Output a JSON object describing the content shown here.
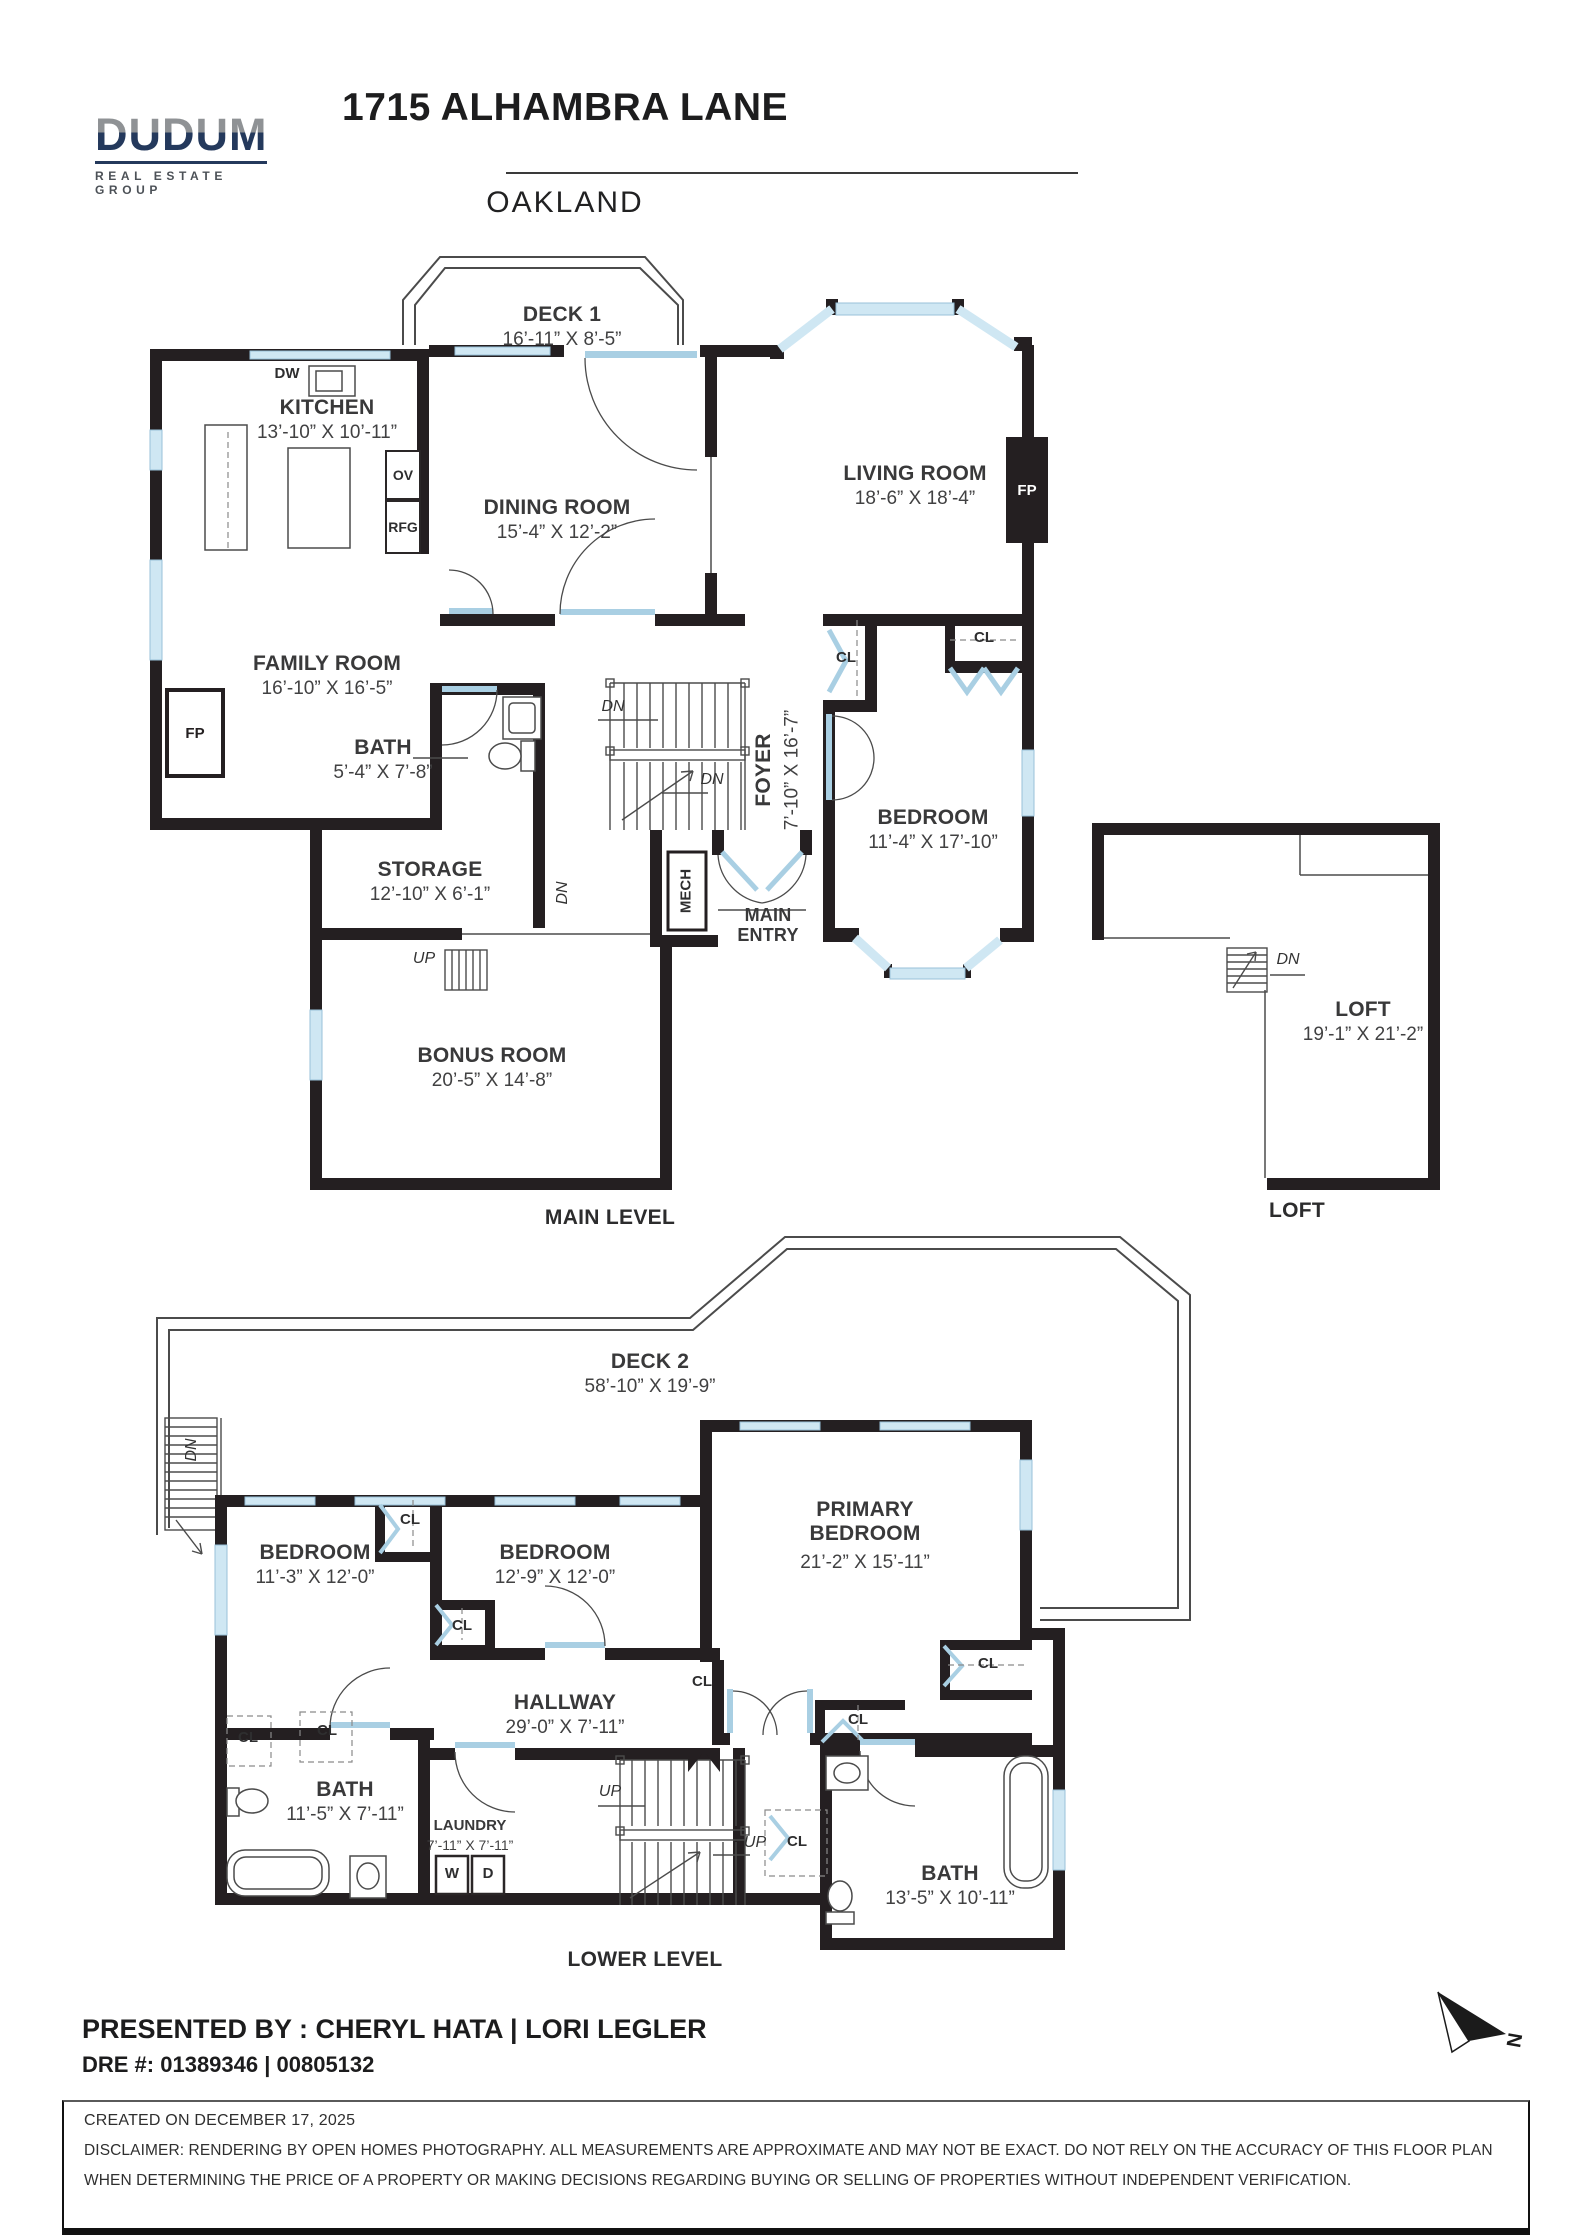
{
  "header": {
    "brand": "DUDUM",
    "brand_tagline": "REAL ESTATE GROUP",
    "title": "1715 ALHAMBRA LANE",
    "subtitle": "OAKLAND"
  },
  "main": {
    "caption": "MAIN LEVEL",
    "deck1": {
      "name": "DECK 1",
      "dims": "16’-11” X 8’-5”"
    },
    "kitchen": {
      "name": "KITCHEN",
      "dims": "13’-10” X 10’-11”"
    },
    "dining": {
      "name": "DINING ROOM",
      "dims": "15’-4” X 12’-2”"
    },
    "living": {
      "name": "LIVING ROOM",
      "dims": "18’-6” X 18’-4”"
    },
    "family": {
      "name": "FAMILY ROOM",
      "dims": "16’-10” X 16’-5”"
    },
    "bath": {
      "name": "BATH",
      "dims": "5’-4” X 7’-8”"
    },
    "foyer": {
      "name": "FOYER",
      "dims": "7’-10” X 16’-7”"
    },
    "bedroom": {
      "name": "BEDROOM",
      "dims": "11’-4” X 17’-10”"
    },
    "storage": {
      "name": "STORAGE",
      "dims": "12’-10” X 6’-1”"
    },
    "bonus": {
      "name": "BONUS ROOM",
      "dims": "20’-5” X 14’-8”"
    },
    "main_entry": "MAIN ENTRY",
    "loft": {
      "name": "LOFT",
      "dims": "19’-1” X 21’-2”",
      "caption": "LOFT"
    }
  },
  "lower": {
    "caption": "LOWER LEVEL",
    "deck2": {
      "name": "DECK 2",
      "dims": "58’-10” X 19’-9”"
    },
    "bedroom1": {
      "name": "BEDROOM",
      "dims": "11’-3” X 12’-0”"
    },
    "bedroom2": {
      "name": "BEDROOM",
      "dims": "12’-9” X 12’-0”"
    },
    "primary": {
      "name": "PRIMARY BEDROOM",
      "dims": "21’-2” X 15’-11”"
    },
    "hallway": {
      "name": "HALLWAY",
      "dims": "29’-0” X 7’-11”"
    },
    "bath1": {
      "name": "BATH",
      "dims": "11’-5” X 7’-11”"
    },
    "laundry": {
      "name": "LAUNDRY",
      "dims": "7’-11” X 7’-11”"
    },
    "bath2": {
      "name": "BATH",
      "dims": "13’-5” X 10’-11”"
    }
  },
  "labels": {
    "dw": "DW",
    "ov": "OV",
    "rfg": "RFG",
    "fp": "FP",
    "cl": "CL",
    "mech": "MECH",
    "dn": "DN",
    "up": "UP",
    "w": "W",
    "d": "D",
    "north": "N"
  },
  "footer": {
    "presented_by": "PRESENTED BY : CHERYL HATA | LORI LEGLER",
    "dre": "DRE #: 01389346 | 00805132",
    "created": "CREATED ON DECEMBER 17, 2025",
    "disclaimer_line1": "DISCLAIMER: RENDERING BY OPEN HOMES PHOTOGRAPHY. ALL MEASUREMENTS ARE APPROXIMATE AND MAY NOT BE EXACT. DO NOT RELY ON THE ACCURACY OF THIS FLOOR PLAN",
    "disclaimer_line2": "WHEN DETERMINING THE PRICE OF A PROPERTY OR MAKING DECISIONS REGARDING BUYING OR SELLING OF PROPERTIES WITHOUT INDEPENDENT VERIFICATION."
  },
  "colors": {
    "wall": "#241f21",
    "window": "#cfe7f3",
    "door": "#a9cfe3",
    "brand_navy": "#24395c",
    "brand_gray": "#8f9295"
  }
}
